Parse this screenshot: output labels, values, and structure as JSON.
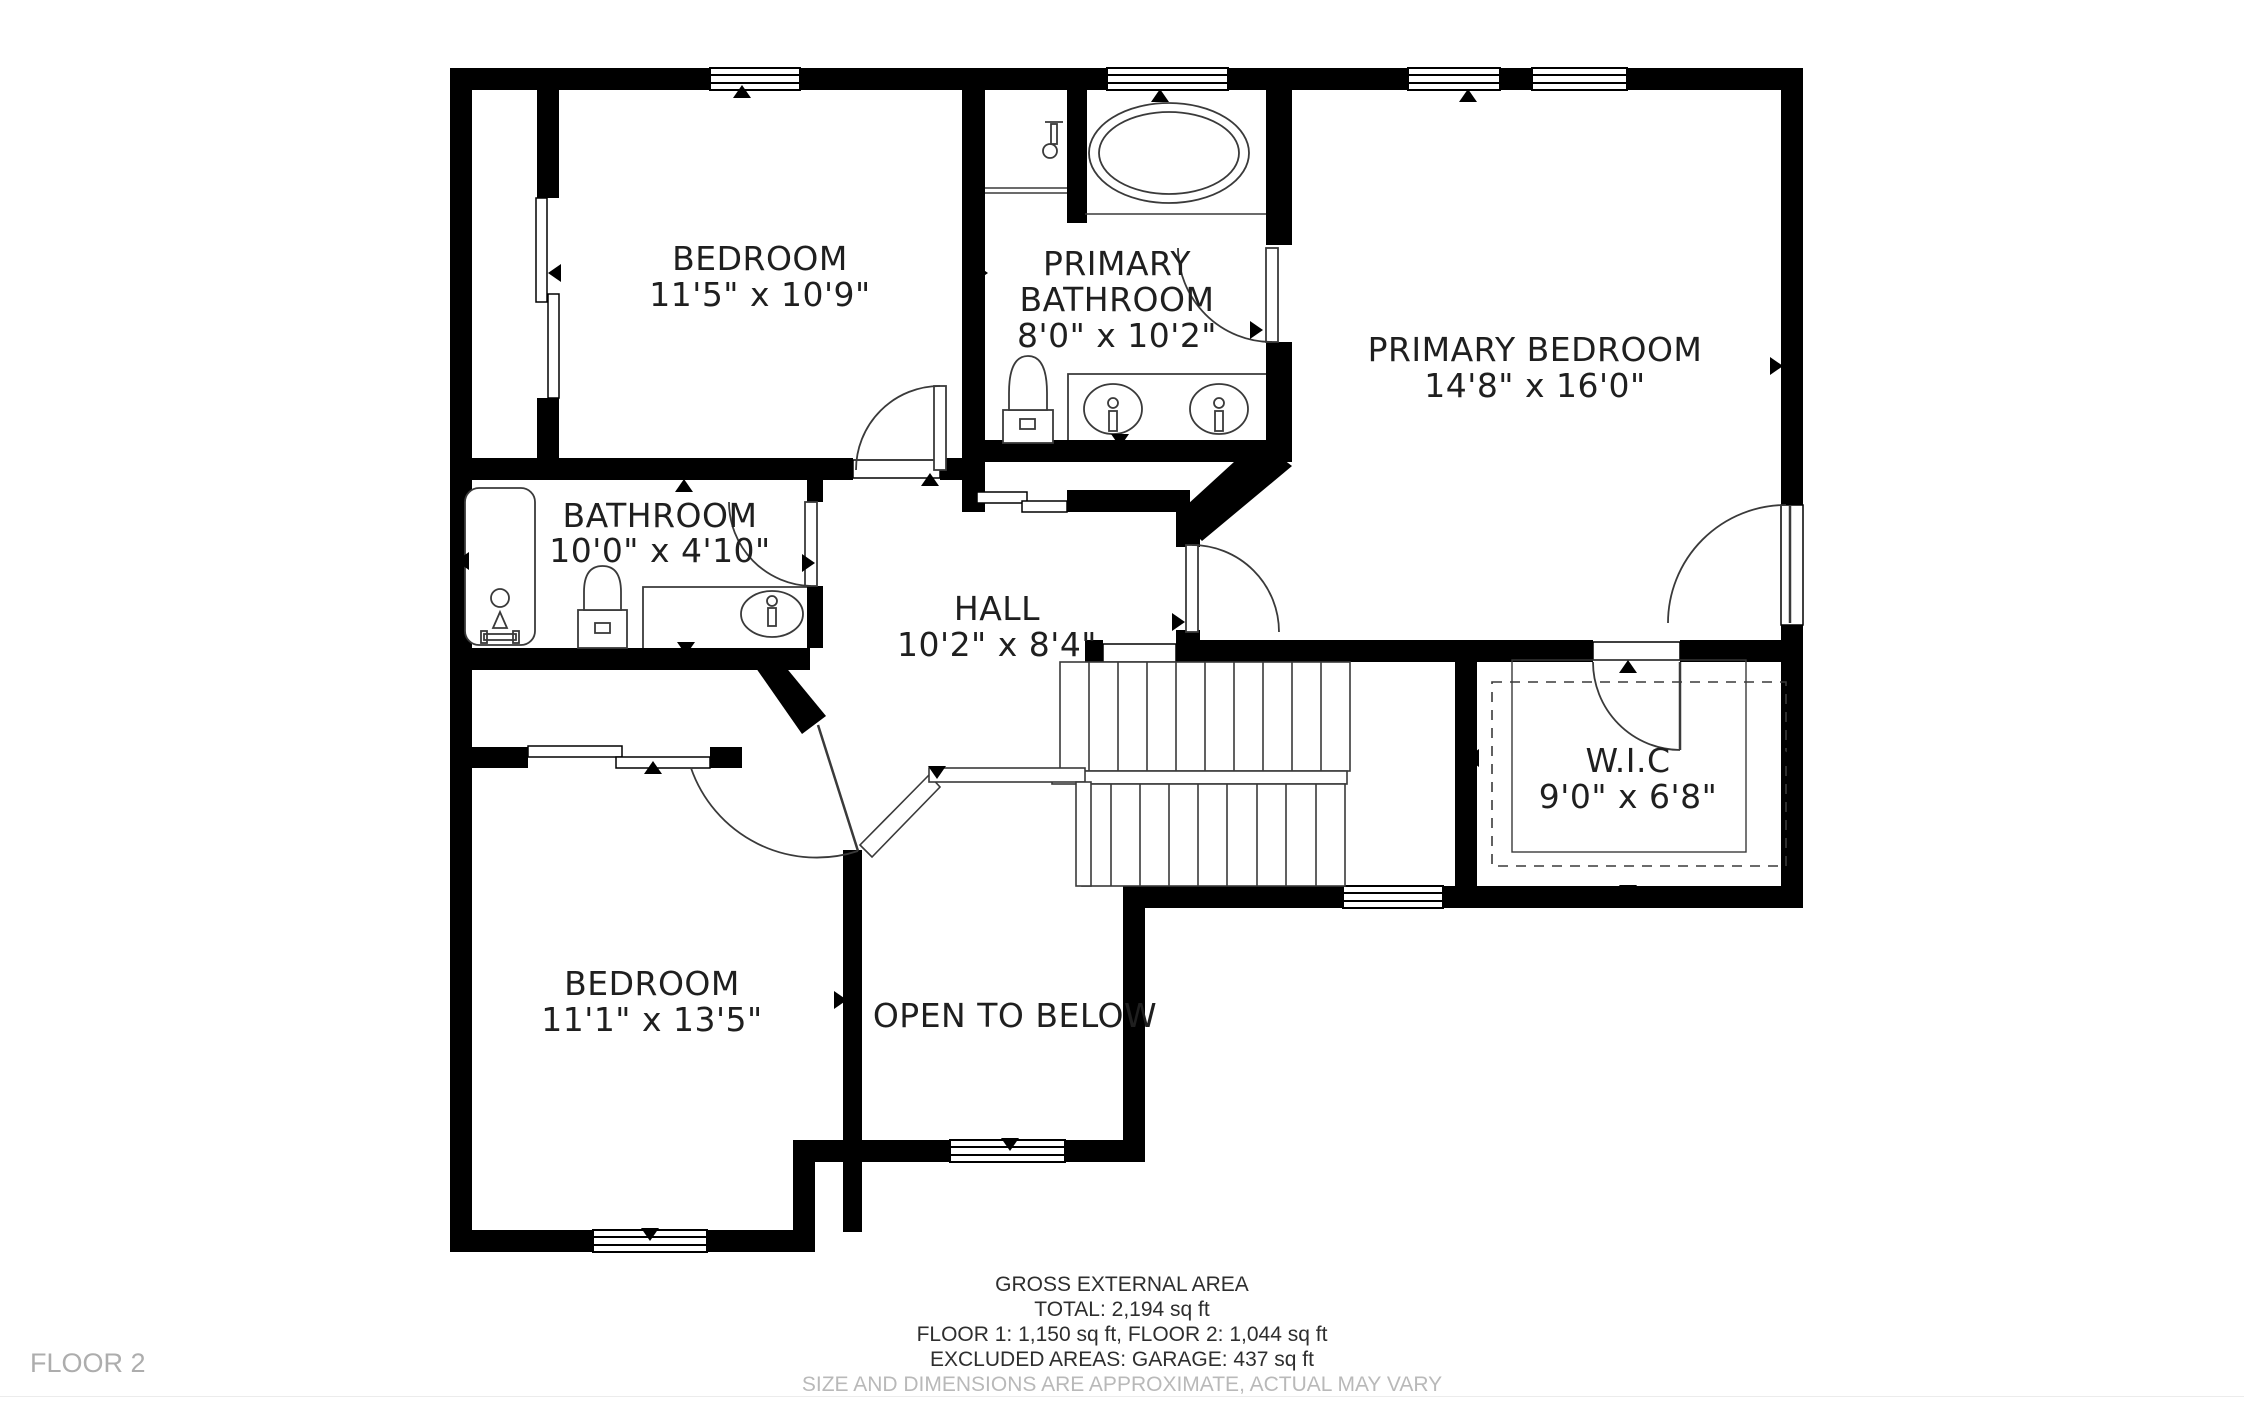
{
  "floor_label": "FLOOR 2",
  "rooms": [
    {
      "name": "BEDROOM",
      "dims": "11'5\" x 10'9\""
    },
    {
      "name": "PRIMARY BATHROOM",
      "name_line1": "PRIMARY",
      "name_line2": "BATHROOM",
      "dims": "8'0\" x 10'2\""
    },
    {
      "name": "PRIMARY BEDROOM",
      "dims": "14'8\" x 16'0\""
    },
    {
      "name": "BATHROOM",
      "dims": "10'0\" x 4'10\""
    },
    {
      "name": "HALL",
      "dims": "10'2\" x 8'4\""
    },
    {
      "name": "W.I.C",
      "dims": "9'0\" x 6'8\""
    },
    {
      "name": "BEDROOM",
      "dims": "11'1\" x 13'5\""
    },
    {
      "name": "OPEN TO BELOW",
      "dims": ""
    }
  ],
  "footer": {
    "line1": "GROSS EXTERNAL AREA",
    "line2": "TOTAL: 2,194 sq ft",
    "line3": "FLOOR 1: 1,150 sq ft, FLOOR 2: 1,044 sq ft",
    "line4": "EXCLUDED AREAS: GARAGE: 437 sq ft",
    "disclaimer": "SIZE AND DIMENSIONS ARE APPROXIMATE, ACTUAL MAY VARY"
  },
  "colors": {
    "wall": "#000000",
    "line": "#3a3a3a",
    "text": "#1f1f1f",
    "muted": "#adadad"
  },
  "icons": [
    "window",
    "door-swing-arc",
    "sliding-bypass-door",
    "bathtub",
    "oval-bathtub",
    "toilet",
    "sink",
    "double-vanity",
    "shower-head",
    "stairs",
    "railing",
    "closet-rod-dashed",
    "direction-marker"
  ]
}
